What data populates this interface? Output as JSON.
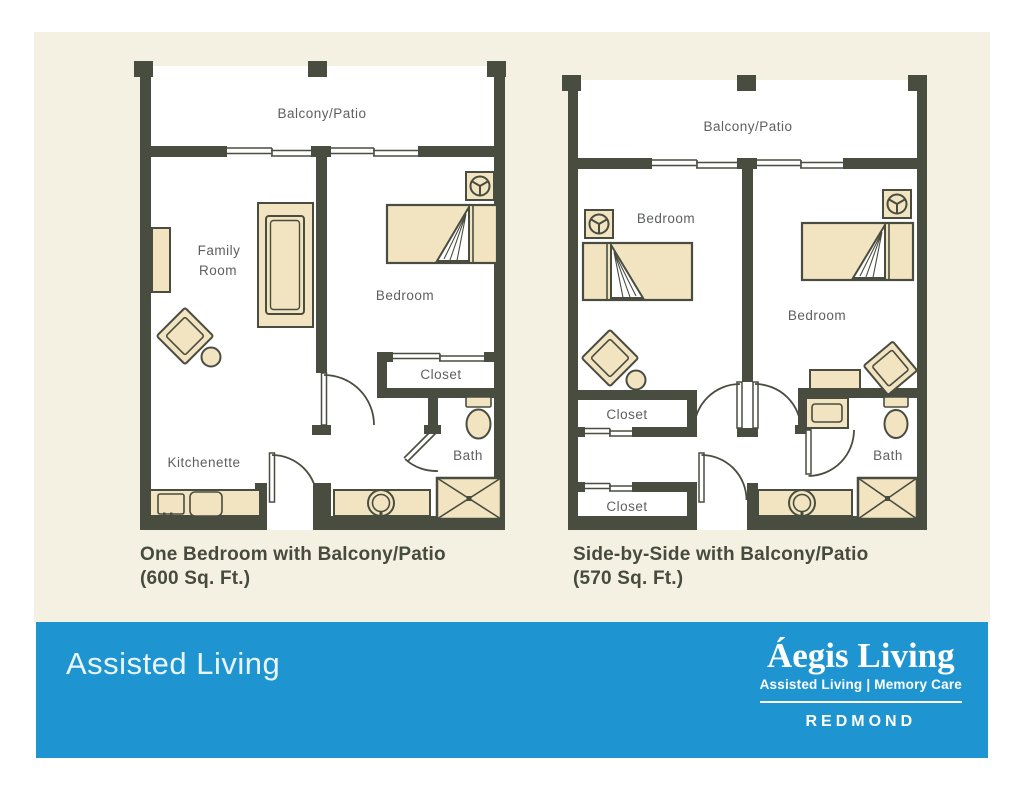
{
  "colors": {
    "background": "#ffffff",
    "board": "#f4f1e2",
    "wall": "#494d40",
    "furniture": "#f2e4c0",
    "room": "#ffffff",
    "label": "#5d5f60",
    "caption": "#474b3e",
    "banner": "#1e95d1",
    "banner_text": "#ffffff"
  },
  "plans": [
    {
      "name": "one-bedroom",
      "labels": {
        "balcony": "Balcony/Patio",
        "family_line1": "Family",
        "family_line2": "Room",
        "bedroom": "Bedroom",
        "closet": "Closet",
        "bath": "Bath",
        "kitchenette": "Kitchenette"
      },
      "caption_line1": "One Bedroom with Balcony/Patio",
      "caption_line2": "(600 Sq. Ft.)"
    },
    {
      "name": "side-by-side",
      "labels": {
        "balcony": "Balcony/Patio",
        "bedroom_left": "Bedroom",
        "bedroom_right": "Bedroom",
        "closet_top": "Closet",
        "closet_bottom": "Closet",
        "bath": "Bath"
      },
      "caption_line1": "Side-by-Side with Balcony/Patio",
      "caption_line2": "(570 Sq. Ft.)"
    }
  ],
  "banner": {
    "left_text": "Assisted Living",
    "logo": {
      "brand": "Áegis Living",
      "tagline": "Assisted Living | Memory Care",
      "location": "REDMOND"
    }
  }
}
